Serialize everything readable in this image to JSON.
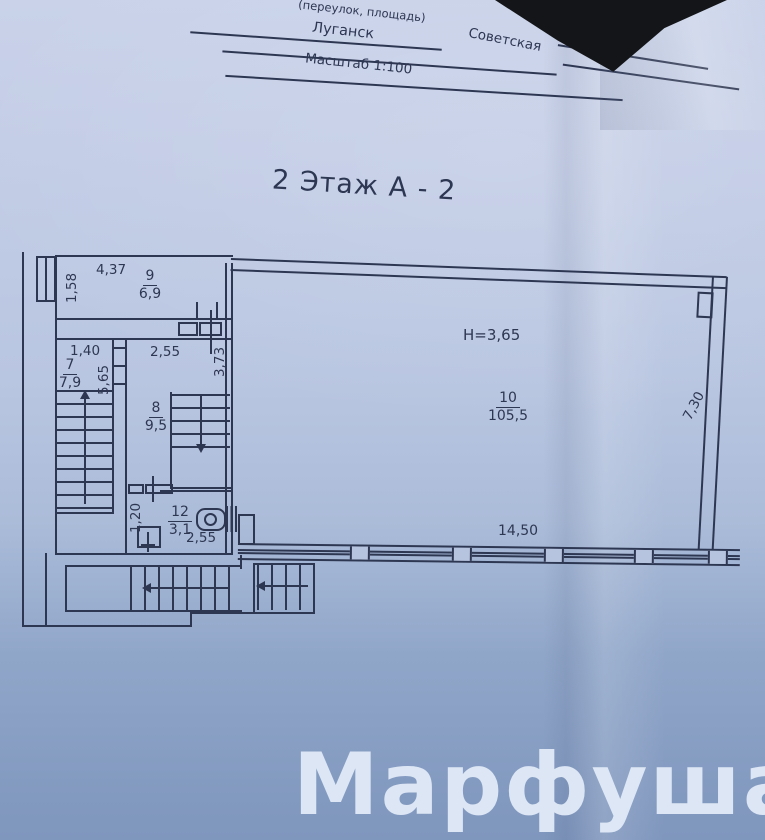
{
  "header": {
    "field_label": "(переулок, площадь)",
    "city": "Луганск",
    "street": "Советская",
    "scale_label": "Масштаб 1:100"
  },
  "title": "2 Этаж  А - 2",
  "watermark": "Марфуша",
  "plan": {
    "ceiling_height": "H=3,65",
    "rooms": {
      "r9": {
        "number": "9",
        "area": "6,9"
      },
      "r7": {
        "number": "7",
        "area": "7,9"
      },
      "r8": {
        "number": "8",
        "area": "9,5"
      },
      "r12": {
        "number": "12",
        "area": "3,1"
      },
      "r10": {
        "number": "10",
        "area": "105,5"
      }
    },
    "dims": {
      "r9_w": "4,37",
      "r9_h": "1,58",
      "r7_w": "1,40",
      "r7_h": "5,65",
      "r8_w": "2,55",
      "r8_h": "3,73",
      "r12_h": "1,20",
      "r12_w": "2,55",
      "r10_w": "14,50",
      "r10_h": "7,30"
    }
  },
  "colors": {
    "ink": "#2e3752",
    "paper": "#b7c4df",
    "watermark_color": "#e4edfa",
    "background_dark": "#17181b"
  }
}
